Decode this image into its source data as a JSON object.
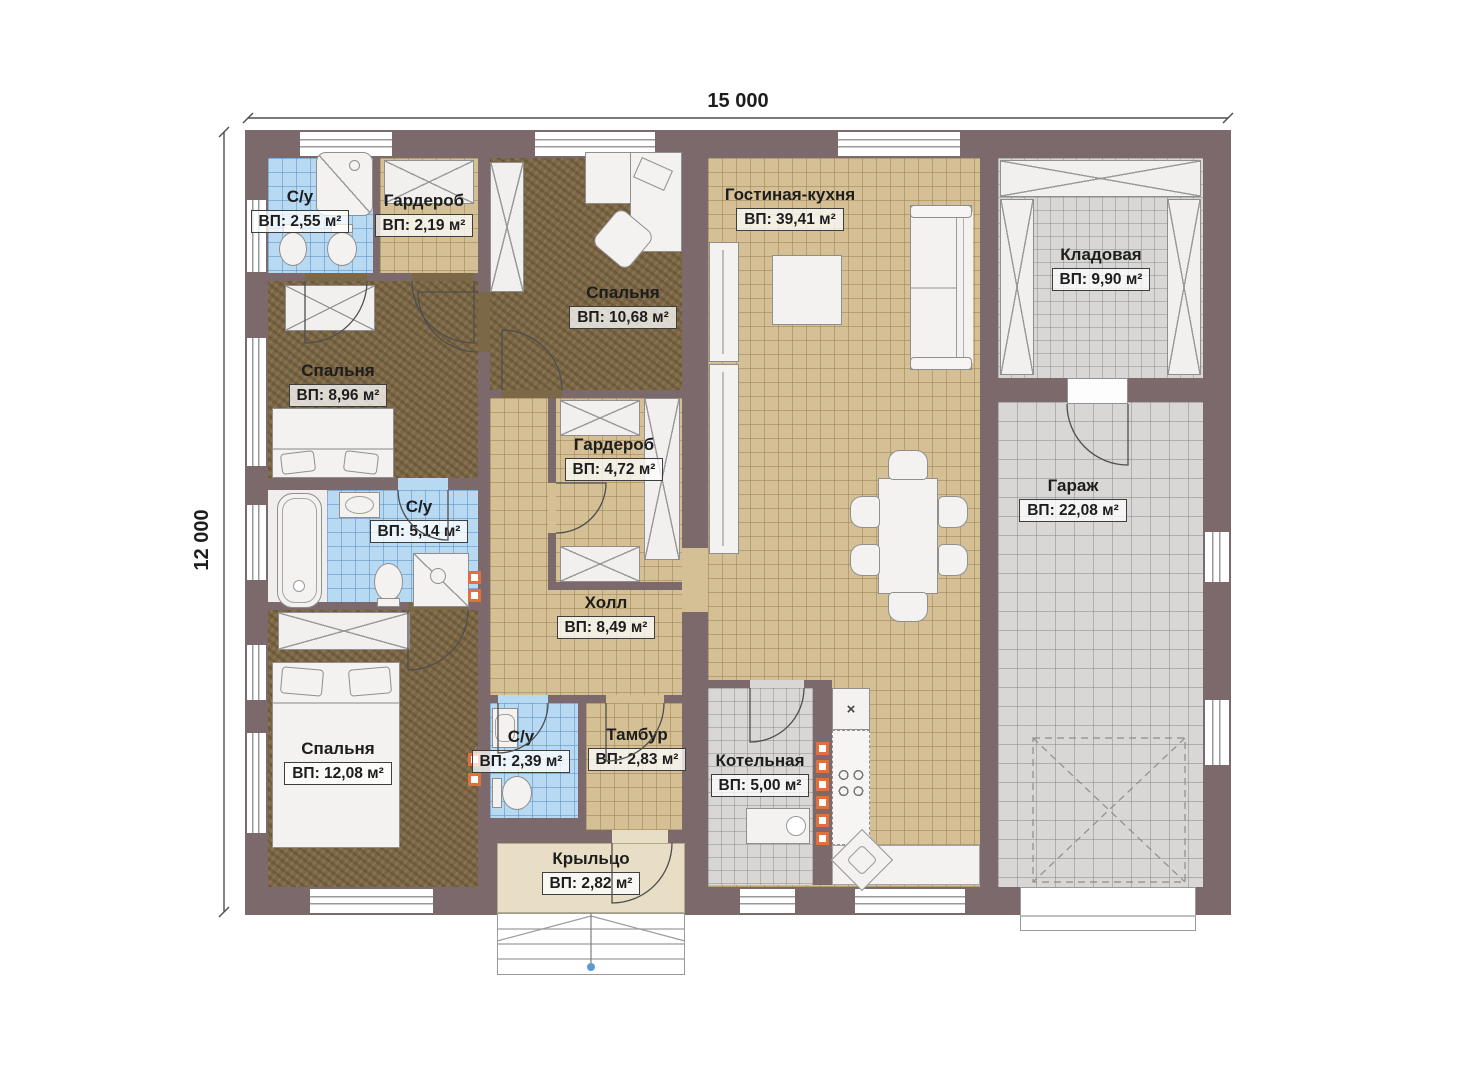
{
  "dimensions": {
    "width_label": "15 000",
    "height_label": "12 000"
  },
  "rooms": {
    "wc_top": {
      "name": "С/у",
      "area": "ВП: 2,55 м²"
    },
    "wardrobe_top": {
      "name": "Гардероб",
      "area": "ВП: 2,19 м²"
    },
    "bedroom_top": {
      "name": "Спальня",
      "area": "ВП: 10,68 м²"
    },
    "living_kitchen": {
      "name": "Гостиная-кухня",
      "area": "ВП: 39,41 м²"
    },
    "pantry": {
      "name": "Кладовая",
      "area": "ВП: 9,90 м²"
    },
    "bedroom_mid": {
      "name": "Спальня",
      "area": "ВП: 8,96 м²"
    },
    "wardrobe_mid": {
      "name": "Гардероб",
      "area": "ВП: 4,72 м²"
    },
    "garage": {
      "name": "Гараж",
      "area": "ВП: 22,08 м²"
    },
    "wc_mid": {
      "name": "С/у",
      "area": "ВП: 5,14 м²"
    },
    "hall": {
      "name": "Холл",
      "area": "ВП: 8,49 м²"
    },
    "bedroom_bottom": {
      "name": "Спальня",
      "area": "ВП: 12,08 м²"
    },
    "wc_bottom": {
      "name": "С/у",
      "area": "ВП: 2,39 м²"
    },
    "vestibule": {
      "name": "Тамбур",
      "area": "ВП: 2,83 м²"
    },
    "boiler_room": {
      "name": "Котельная",
      "area": "ВП: 5,00 м²"
    },
    "porch": {
      "name": "Крыльцо",
      "area": "ВП: 2,82 м²"
    }
  },
  "fixtures": {
    "cross_mark": "×"
  },
  "colors": {
    "wall": "#7b696b",
    "tile_tan": "#d4c094",
    "tile_blue": "#b7d9f1",
    "tile_gray": "#d8d7d5",
    "wood": "#7c6847",
    "porch": "#e8dec6",
    "radiator": "#e2703c",
    "step_dot": "#5b9bd5"
  }
}
